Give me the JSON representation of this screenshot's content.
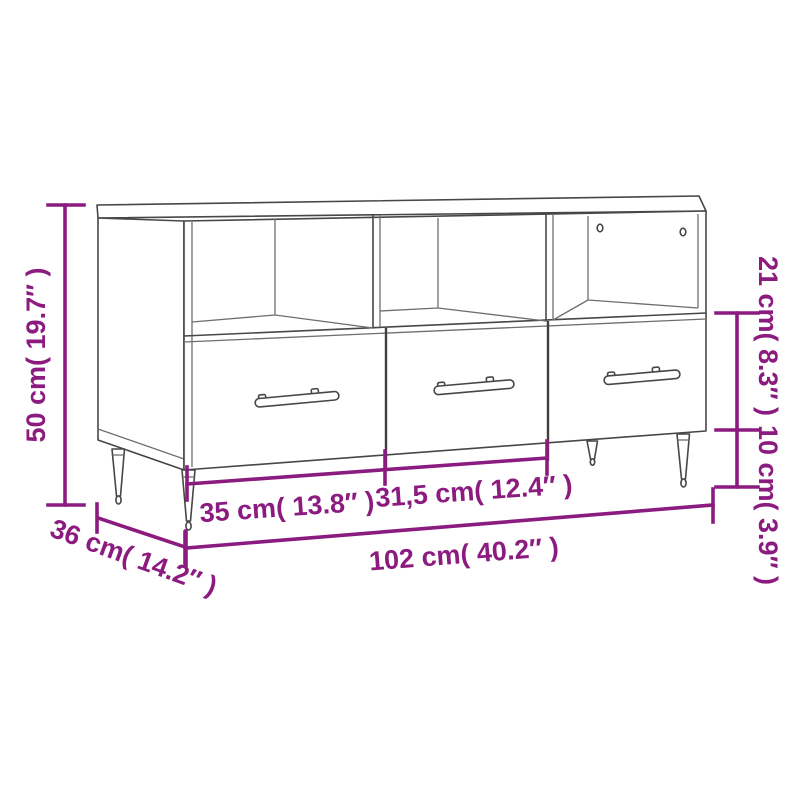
{
  "page": {
    "background_color": "#ffffff",
    "content": "Product dimension diagram of a TV cabinet with three open compartments, two cable holes, three drawers with bar handles and four tapered metal legs"
  },
  "diagram": {
    "accent_color": "#8c1b80",
    "outline_color": "#474747",
    "dimensions": {
      "total_height": {
        "label": "50 cm( 19.7″ )",
        "cm": "50",
        "inches": "19.7",
        "position": "left-vertical"
      },
      "drawer_front_height": {
        "label": "21 cm( 8.3″ )",
        "cm": "21",
        "inches": "8.3",
        "position": "right-vertical-upper"
      },
      "leg_height": {
        "label": "10 cm( 3.9″ )",
        "cm": "10",
        "inches": "3.9",
        "position": "right-vertical-lower"
      },
      "left_drawer_width": {
        "label": "35 cm( 13.8″ )",
        "cm": "35",
        "inches": "13.8",
        "position": "bottom-left-segment"
      },
      "middle_drawer_width": {
        "label": "31,5 cm( 12.4″ )",
        "cm": "31,5",
        "inches": "12.4",
        "position": "bottom-middle-segment"
      },
      "total_width": {
        "label": "102 cm( 40.2″ )",
        "cm": "102",
        "inches": "40.2",
        "position": "bottom-full"
      },
      "depth": {
        "label": "36 cm( 14.2″ )",
        "cm": "36",
        "inches": "14.2",
        "position": "bottom-left-diagonal"
      }
    }
  }
}
